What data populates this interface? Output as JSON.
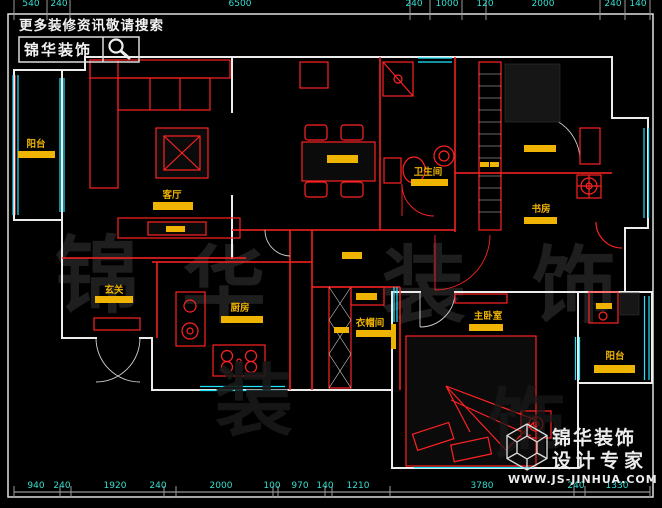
{
  "branding_top": {
    "tagline": "更多装修资讯敬请搜索",
    "logo_text": "锦华装饰",
    "search_icon": "magnifier-icon"
  },
  "branding_bottom": {
    "company": "锦华装饰",
    "slogan": "设计专家",
    "website": "WWW.JS-JINHUA.COM",
    "logo": "wireframe-cube-icon"
  },
  "watermark": {
    "char1": "锦",
    "char2": "华",
    "char3": "装",
    "char4": "饰",
    "char5": "装",
    "char6": "饰"
  },
  "rooms": {
    "balcony_left": "阳台",
    "living": "客厅",
    "entry": "玄关",
    "kitchen": "厨房",
    "bath": "卫生间",
    "study": "书房",
    "cloak": "衣帽间",
    "master": "主卧室",
    "balcony_right": "阳台"
  },
  "dims_bottom": [
    "940",
    "240",
    "1920",
    "240",
    "2000",
    "100",
    "970",
    "140",
    "1210",
    "3780",
    "240",
    "1330"
  ],
  "dims_top": [
    "540",
    "240",
    "6500",
    "240",
    "1000",
    "120",
    "2000",
    "240",
    "140"
  ],
  "colors": {
    "background": "#000000",
    "wall": "#ececec",
    "interior_wall": "#ff2222",
    "window": "#1fe6ff",
    "label": "#f0b400",
    "label_bar": "#efb301",
    "dimension": "#35dfd0",
    "watermark": "#1e1e1e",
    "branding": "#f2f2f2"
  }
}
